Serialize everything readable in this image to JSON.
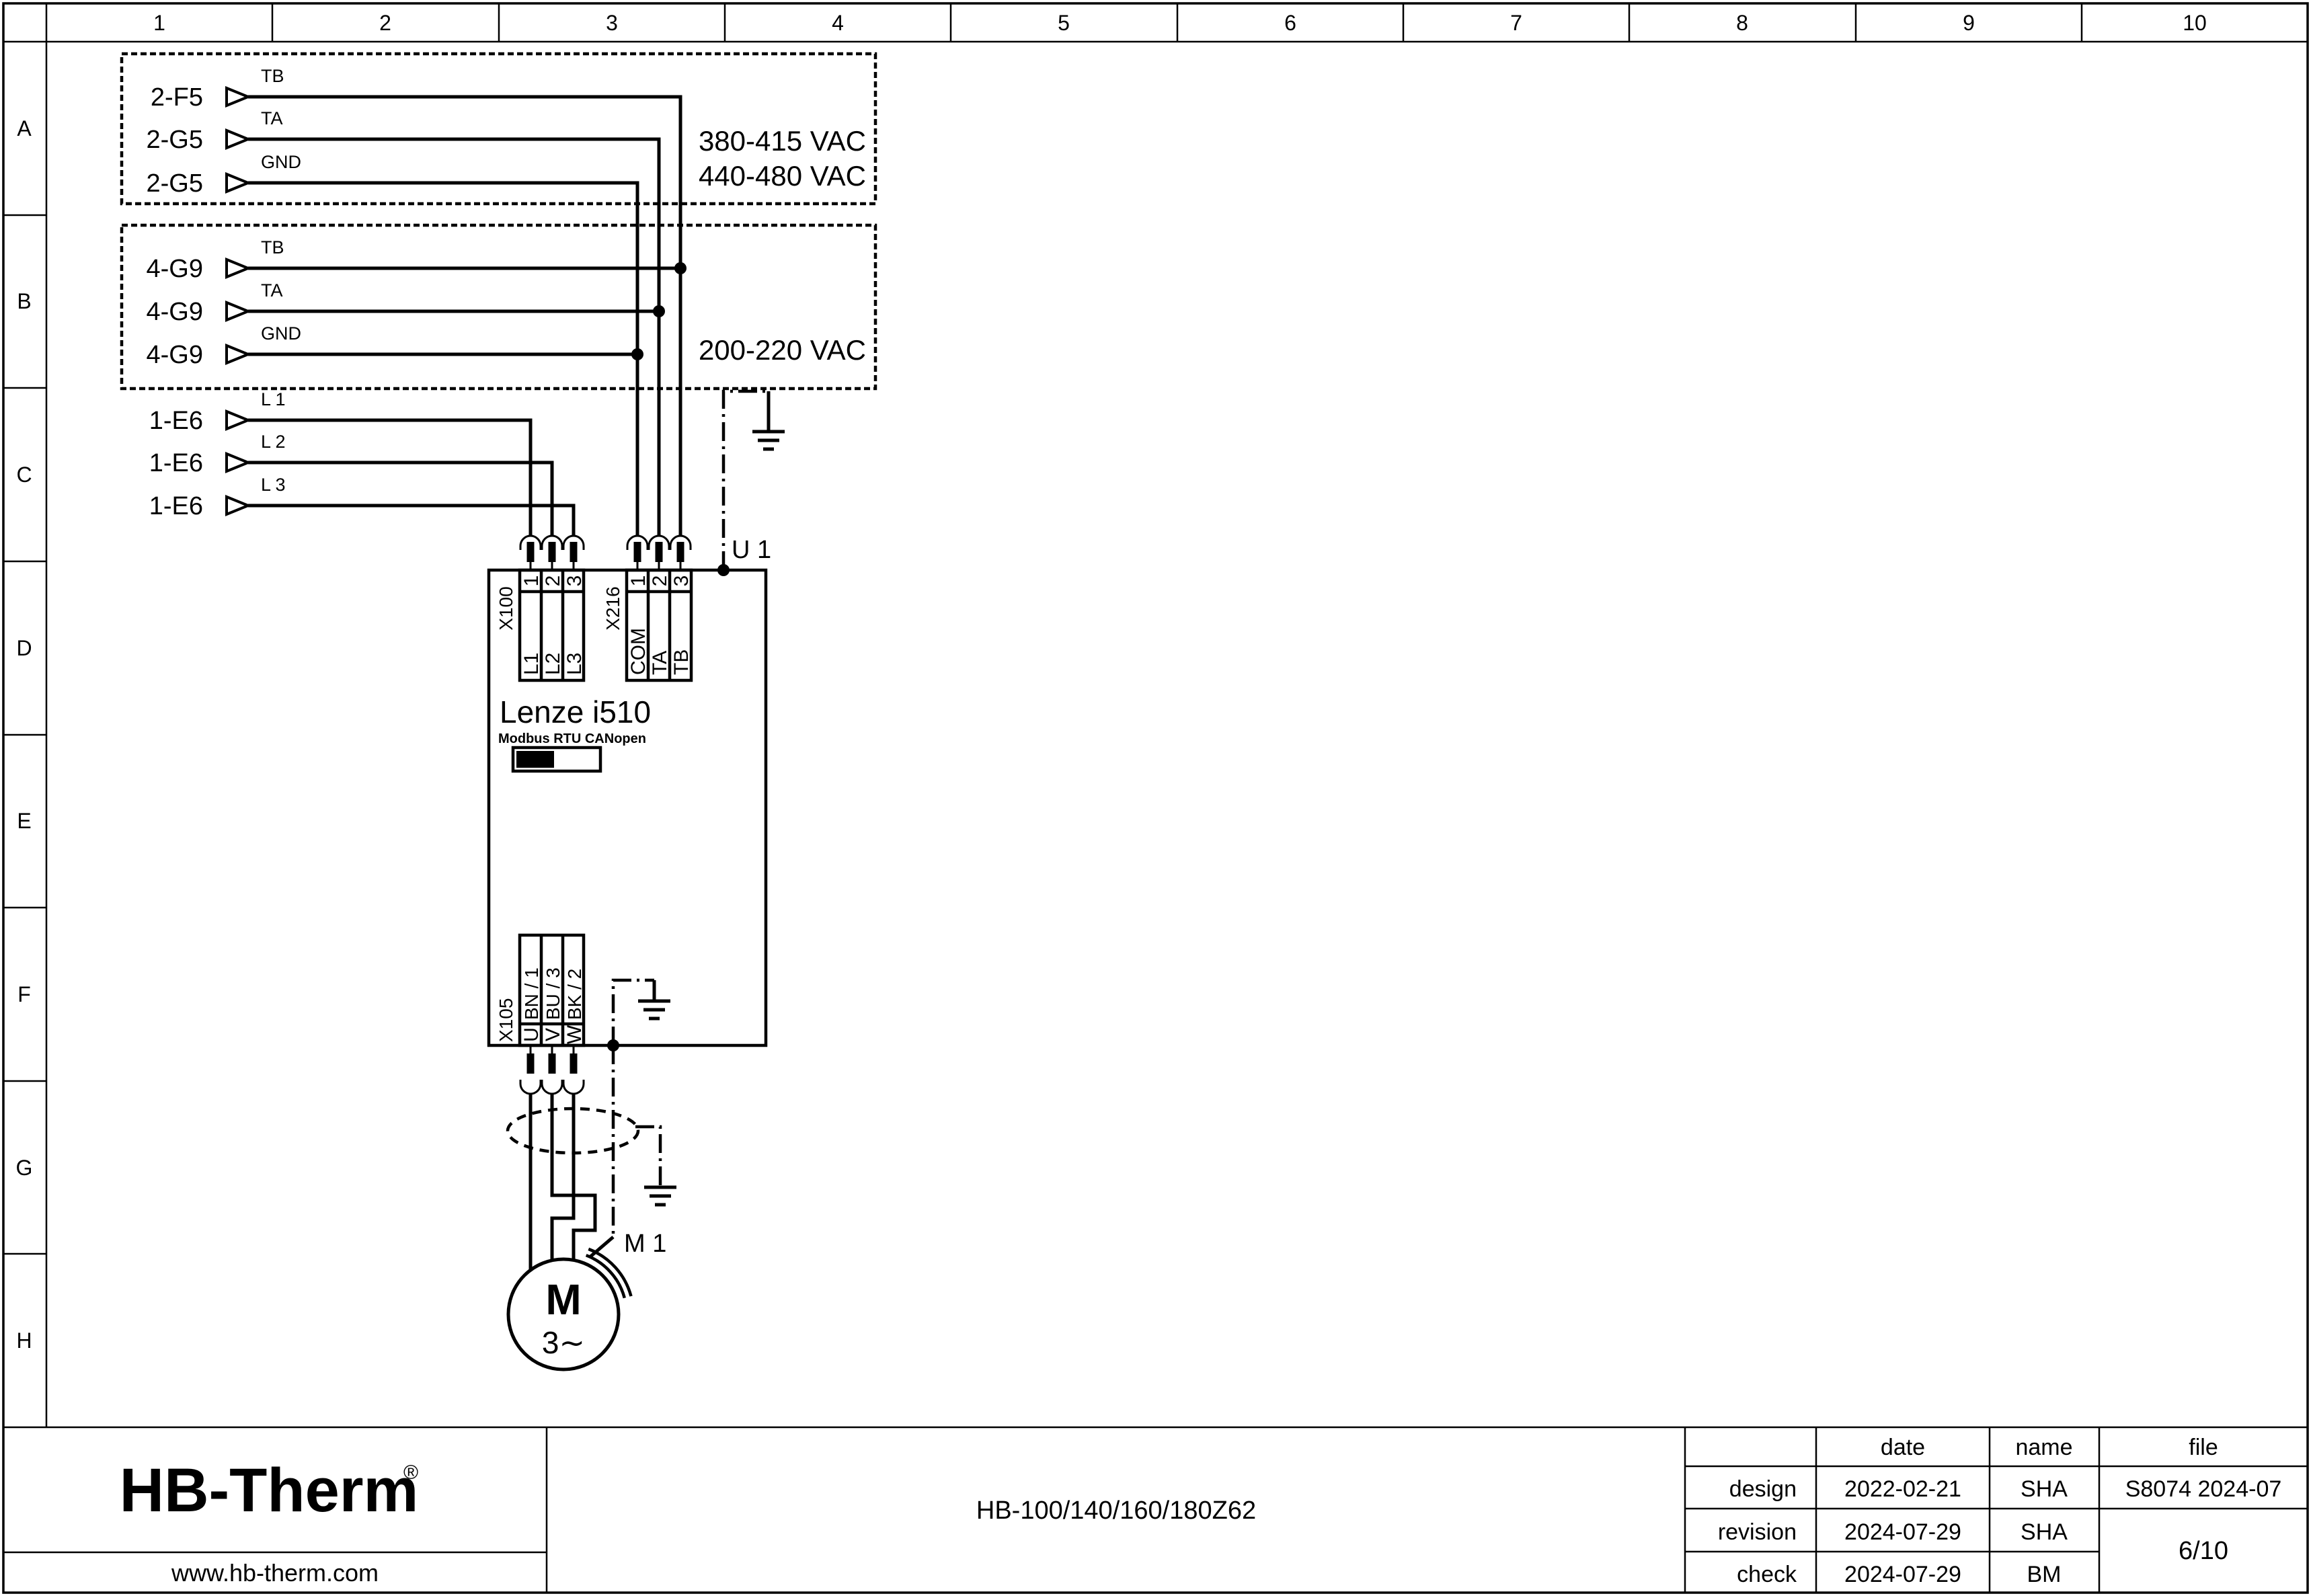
{
  "grid": {
    "cols": [
      "1",
      "2",
      "3",
      "4",
      "5",
      "6",
      "7",
      "8",
      "9",
      "10"
    ],
    "rows": [
      "A",
      "B",
      "C",
      "D",
      "E",
      "F",
      "G",
      "H"
    ]
  },
  "sources": {
    "box_a": {
      "rows": [
        {
          "ref": "2-F5",
          "signal": "TB"
        },
        {
          "ref": "2-G5",
          "signal": "TA"
        },
        {
          "ref": "2-G5",
          "signal": "GND"
        }
      ],
      "voltage1": "380-415 VAC",
      "voltage2": "440-480 VAC"
    },
    "box_b": {
      "rows": [
        {
          "ref": "4-G9",
          "signal": "TB"
        },
        {
          "ref": "4-G9",
          "signal": "TA"
        },
        {
          "ref": "4-G9",
          "signal": "GND"
        }
      ],
      "voltage": "200-220 VAC"
    },
    "mains": {
      "rows": [
        {
          "ref": "1-E6",
          "signal": "L 1"
        },
        {
          "ref": "1-E6",
          "signal": "L 2"
        },
        {
          "ref": "1-E6",
          "signal": "L 3"
        }
      ]
    }
  },
  "drive": {
    "designation": "U 1",
    "model": "Lenze i510",
    "comm": "Modbus RTU CANopen",
    "x100": {
      "label": "X100",
      "pins": [
        "1",
        "2",
        "3"
      ],
      "nets": [
        "L1",
        "L2",
        "L3"
      ]
    },
    "x216": {
      "label": "X216",
      "pins": [
        "1",
        "2",
        "3"
      ],
      "nets": [
        "COM",
        "TA",
        "TB"
      ]
    },
    "x105": {
      "label": "X105",
      "pins": [
        "U",
        "V",
        "W"
      ],
      "wires": [
        "BN / 1",
        "BU / 3",
        "BK / 2"
      ]
    }
  },
  "motor": {
    "designation": "M 1",
    "symbol": "M",
    "phase": "3∼"
  },
  "titleblock": {
    "brand": "HB-Therm",
    "reg": "®",
    "website": "www.hb-therm.com",
    "doc_title": "HB-100/140/160/180Z62",
    "headers": {
      "date": "date",
      "name": "name",
      "file": "file"
    },
    "rows": [
      {
        "label": "design",
        "date": "2022-02-21",
        "name": "SHA"
      },
      {
        "label": "revision",
        "date": "2024-07-29",
        "name": "SHA"
      },
      {
        "label": "check",
        "date": "2024-07-29",
        "name": "BM"
      }
    ],
    "file_no": "S8074 2024-07",
    "page": "6/10"
  },
  "colors": {
    "logo_navy": "#1f2747",
    "line": "#000000"
  }
}
